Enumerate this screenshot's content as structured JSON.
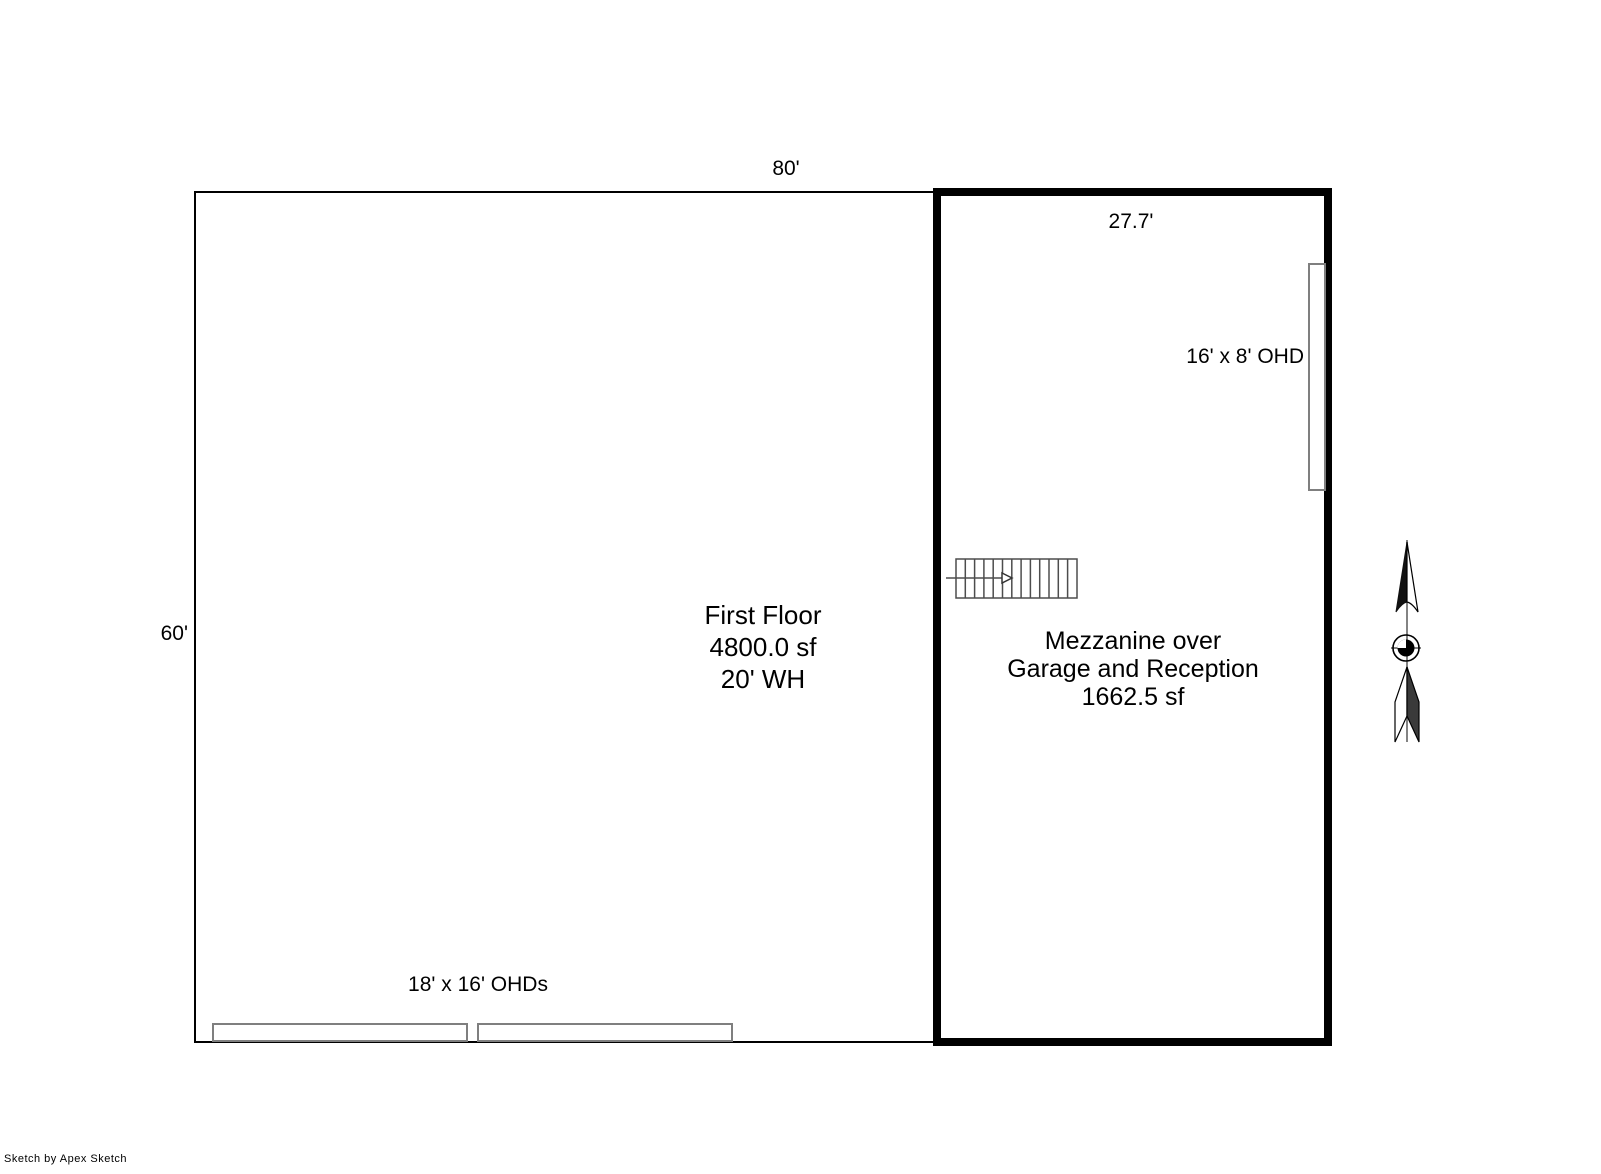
{
  "footer": {
    "credit": "Sketch by Apex Sketch"
  },
  "colors": {
    "wall": "#000000",
    "door_outline": "#7f7f7f",
    "stair_stroke": "#4d4d4d",
    "north_gray": "#5a5a5a",
    "text": "#000000"
  },
  "first_floor": {
    "name": "First Floor",
    "area": "4800.0 sf",
    "wall_height": "20' WH",
    "top_dim": "80'",
    "left_dim": "60'",
    "bottom_doors_label": "18' x 16' OHDs"
  },
  "mezzanine": {
    "name_line1": "Mezzanine over",
    "name_line2": "Garage and Reception",
    "area": "1662.5 sf",
    "top_dim": "27.7'",
    "right_door_label": "16' x 8' OHD"
  }
}
